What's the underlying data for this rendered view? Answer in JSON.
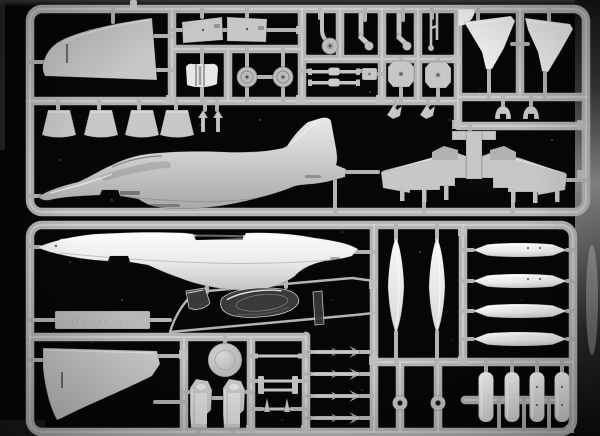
{
  "image": {
    "alt": "Photograph of two grey/white injection-moulded plastic model kit sprues (BAe Hawk jet trainer parts: fuselage halves, wings, drop tanks, pylons, wheels, ejection seats, clear canopy) on a glossy black background"
  },
  "nameplate": {
    "embossed_text": "1/72 BAe HAWK"
  },
  "colors": {
    "background": "#060606",
    "sprue": "#b4b4b4",
    "sprue-highlight": "#e2e2e2",
    "part": "#c7c7c7",
    "part-white": "#f3f3f3",
    "clear-part": "#3a3a3a"
  }
}
